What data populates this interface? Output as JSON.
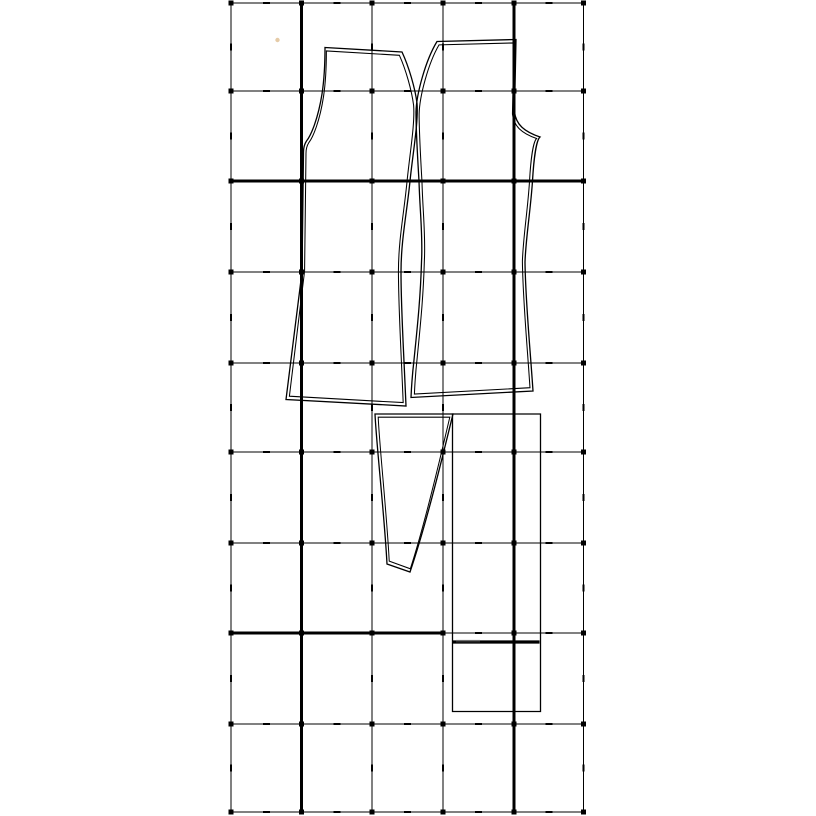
{
  "canvas": {
    "width": 816,
    "height": 816,
    "background": "#ffffff",
    "line_color": "#000000"
  },
  "grid": {
    "x_lines": [
      231,
      301.5,
      372,
      443,
      514,
      583.5
    ],
    "y_lines": [
      3,
      91,
      181,
      272,
      363,
      452,
      543,
      633,
      724,
      812
    ],
    "thin_width": 1,
    "thick_width": 2.7,
    "thick_segments": [
      {
        "orient": "v",
        "x": 301.5,
        "y1": 3,
        "y2": 812
      },
      {
        "orient": "v",
        "x": 514,
        "y1": 3,
        "y2": 812
      },
      {
        "orient": "h",
        "y": 181,
        "x1": 231,
        "x2": 583.5
      },
      {
        "orient": "h",
        "y": 633,
        "x1": 231,
        "x2": 443
      }
    ],
    "intersection_dot_size": 5,
    "midpoint_tick": {
      "length": 7,
      "width": 2.4
    }
  },
  "pieces": [
    {
      "id": "back-panel",
      "double_outline": true,
      "inset": 3.4,
      "stroke_width": 1.3,
      "path": "M325,47.5 L402,52 C409,67 415,88 417,103 C418.5,122 413,152 410,181 C407,212 401,240 401,272 C401,308 403,336 406,406 L286,399.5 L302,272 L303.5,152 C303.5,147 304.5,144 306.5,141 C311,135.5 318,119 322,94 C324.3,79 325,60 325,47.5 Z"
    },
    {
      "id": "front-panel",
      "double_outline": true,
      "inset": 3.4,
      "stroke_width": 1.3,
      "path": "M437,41.5 L516,39.5 L514.5,112 C516,124.5 524,131.5 540,137 C536.5,140 533.8,158 532.5,181 C530.5,211 526,236 525,262 C525.5,302 530,346 533,391 L411,397.5 C411.5,386 412.6,372 414,360 C417,330 420.4,300 421.5,262 C423,236 419.8,211 419,181 C417.6,158 416,131 416,112 C416.4,94 425.5,60.5 437,41.5 Z"
    },
    {
      "id": "gore-panel",
      "double_outline": true,
      "inset": 3.2,
      "stroke_width": 1.3,
      "path": "M375,414 L453,414 C446,442 428,519 410,572 L387,564 C384.5,516 376.5,446 375,414 Z"
    },
    {
      "id": "rectangle-panel",
      "double_outline": false,
      "inset": 0,
      "stroke_width": 1.3,
      "path": "M452.5,414 L540.5,414 L540.5,711.5 L452.5,711.5 Z"
    }
  ],
  "extra_lines": [
    {
      "id": "fold-mark-line",
      "x1": 452.5,
      "y1": 642,
      "x2": 539.5,
      "y2": 642,
      "width": 3.2,
      "color": "#000000"
    }
  ],
  "marks": [
    {
      "id": "stray-dot",
      "type": "dot",
      "x": 277.5,
      "y": 40,
      "r": 2.2,
      "color": "#cfa05f",
      "opacity": 0.55
    },
    {
      "id": "faint-label-smudge",
      "type": "smudge",
      "x": 456,
      "y": 639.5,
      "w": 24,
      "h": 3,
      "color": "#9a9a9a",
      "opacity": 0.25
    }
  ]
}
